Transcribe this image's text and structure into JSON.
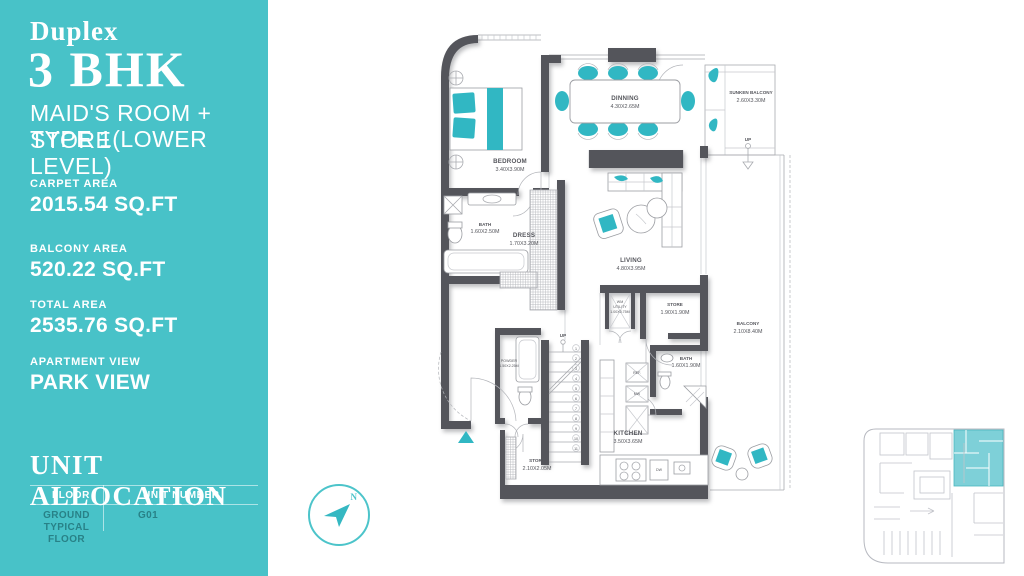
{
  "colors": {
    "sidebar_teal": "#48c2c8",
    "furniture_teal": "#31b7c3",
    "wall_gray": "#54555b",
    "keyplan_unit_teal": "#7ed0d8"
  },
  "sidebar": {
    "duplex": "Duplex",
    "title": "3 BHK",
    "subtitle1": "MAID'S ROOM + STORE",
    "subtitle2": "TYPE 1(LOWER LEVEL)",
    "stats": [
      {
        "label": "CARPET AREA",
        "value": "2015.54 SQ.FT"
      },
      {
        "label": "BALCONY AREA",
        "value": "520.22 SQ.FT"
      },
      {
        "label": "TOTAL AREA",
        "value": "2535.76 SQ.FT"
      },
      {
        "label": "APARTMENT VIEW",
        "value": "PARK VIEW"
      }
    ],
    "unit_allocation": {
      "title": "UNIT ALLOCATION",
      "col_floor": "FLOOR",
      "col_unit": "UNIT NUMBER",
      "floor_line1": "GROUND",
      "floor_line2": "TYPICAL FLOOR",
      "unit_number": "G01"
    }
  },
  "compass": {
    "north": "N"
  },
  "floorplan": {
    "rooms": {
      "bedroom": {
        "name": "BEDROOM",
        "dims": "3.40X3.90M"
      },
      "bath1": {
        "name": "BATH",
        "dims": "1.60X2.50M"
      },
      "dress": {
        "name": "DRESS",
        "dims": "1.70X3.20M"
      },
      "dining": {
        "name": "DINNING",
        "dims": "4.30X2.65M"
      },
      "sunken_balcony": {
        "name": "SUNKEN BALCONY",
        "dims": "2.60X3.30M"
      },
      "living": {
        "name": "LIVING",
        "dims": "4.80X3.95M"
      },
      "utility": {
        "line1": "WM",
        "line2": "UTILITY",
        "dims": "1.00X0.75M"
      },
      "store1": {
        "name": "STORE",
        "dims": "1.90X1.90M"
      },
      "balcony": {
        "name": "BALCONY",
        "dims": "2.10X8.40M"
      },
      "powder": {
        "name": "POWDER",
        "dims": "1.50X2.25M"
      },
      "bath2": {
        "name": "BATH",
        "dims": "1.60X1.90M"
      },
      "kitchen": {
        "name": "KITCHEN",
        "dims": "3.50X3.65M"
      },
      "store2": {
        "name": "STORE",
        "dims": "2.10X2.05M"
      }
    },
    "labels": {
      "up": "UP",
      "ref": "REF.",
      "mw": "MW",
      "dw": "DW"
    },
    "stairs": [
      "1",
      "2",
      "3",
      "4",
      "5",
      "6",
      "7",
      "8",
      "9",
      "10",
      "11"
    ]
  }
}
